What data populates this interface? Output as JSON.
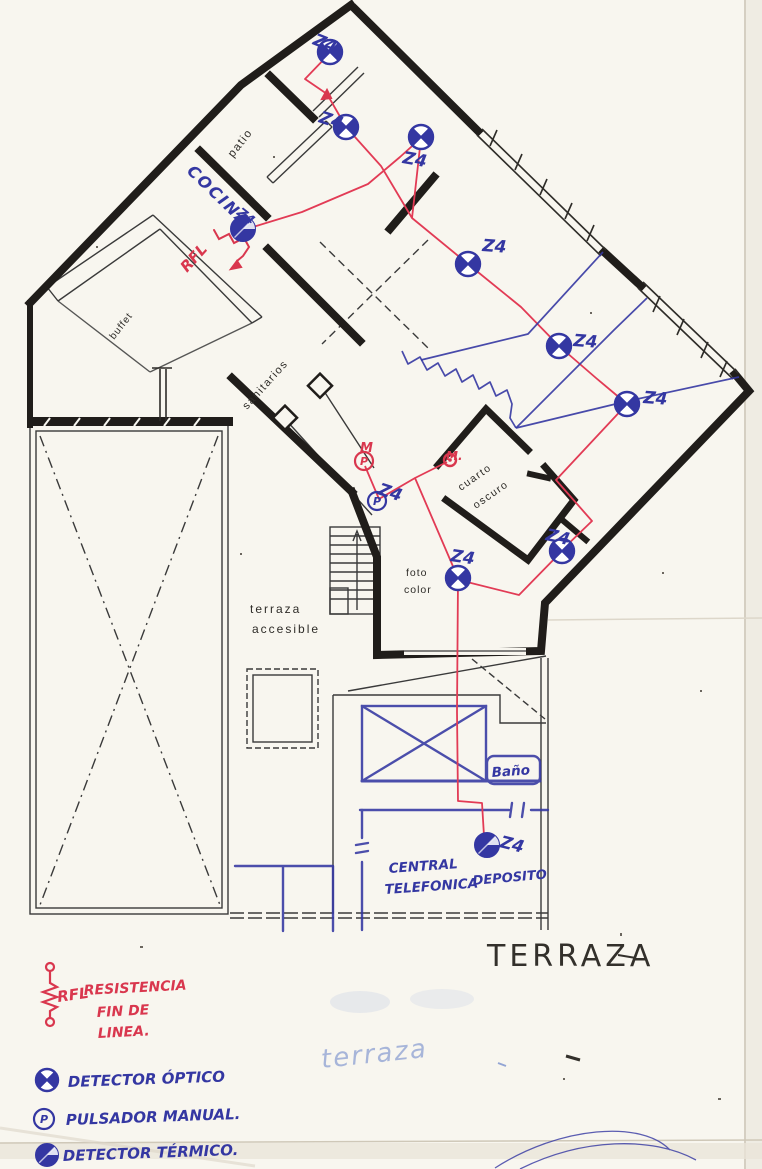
{
  "palette": {
    "pen_red": "#d9374e",
    "wire_red": "#e23b55",
    "pen_blue": "#3437a2",
    "faint_blue": "#93a5d4",
    "wall_black": "#201d1a",
    "print_gray": "#3a3a3a",
    "paper": "#f8f6ef"
  },
  "rooms": {
    "patio": "patio",
    "buffet": "buffet",
    "sanitarios": "sanitarios",
    "cuarto_line1": "cuarto",
    "cuarto_line2": "oscuro",
    "foto_line1": "foto",
    "foto_line2": "color",
    "terraza_line1": "terraza",
    "terraza_line2": "accesible",
    "cocina": "COCINA",
    "cocina_zone": "Z4",
    "bano": "Baño",
    "central_line1": "CENTRAL",
    "central_line2": "TELEFONICA",
    "deposito": "DEPOSITO"
  },
  "annotations": {
    "terraza_title": "TERRAZA",
    "terraza_faint": "terraza",
    "rfl": "RFL",
    "m1": "M",
    "m2": "M."
  },
  "zones": {
    "label": "Z4",
    "positions": [
      {
        "x": 312,
        "y": 44,
        "rot": 22
      },
      {
        "x": 318,
        "y": 122,
        "rot": 18
      },
      {
        "x": 402,
        "y": 163,
        "rot": 10
      },
      {
        "x": 482,
        "y": 251,
        "rot": 4
      },
      {
        "x": 573,
        "y": 346,
        "rot": 4
      },
      {
        "x": 643,
        "y": 403,
        "rot": 4
      },
      {
        "x": 545,
        "y": 540,
        "rot": 12
      },
      {
        "x": 377,
        "y": 494,
        "rot": 18
      },
      {
        "x": 450,
        "y": 561,
        "rot": 8
      },
      {
        "x": 499,
        "y": 847,
        "rot": 14
      }
    ]
  },
  "devices": [
    {
      "type": "optico",
      "x": 330,
      "y": 52
    },
    {
      "type": "optico",
      "x": 346,
      "y": 127
    },
    {
      "type": "optico",
      "x": 421,
      "y": 137
    },
    {
      "type": "optico",
      "x": 468,
      "y": 264
    },
    {
      "type": "optico",
      "x": 559,
      "y": 346
    },
    {
      "type": "optico",
      "x": 627,
      "y": 404
    },
    {
      "type": "optico",
      "x": 562,
      "y": 551
    },
    {
      "type": "optico",
      "x": 458,
      "y": 578
    },
    {
      "type": "termico",
      "x": 487,
      "y": 845
    },
    {
      "type": "termico",
      "x": 243,
      "y": 229
    },
    {
      "type": "pulsador",
      "x": 377,
      "y": 501
    },
    {
      "type": "pulsador-red",
      "x": 364,
      "y": 461
    },
    {
      "type": "punto-red",
      "x": 450,
      "y": 460
    }
  ],
  "wires": {
    "red": [
      [
        [
          330,
          53
        ],
        [
          305,
          79
        ],
        [
          327,
          94
        ],
        [
          346,
          127
        ],
        [
          381,
          166
        ],
        [
          412,
          218
        ],
        [
          468,
          264
        ]
      ],
      [
        [
          240,
          231
        ],
        [
          302,
          212
        ],
        [
          368,
          184
        ],
        [
          400,
          157
        ],
        [
          421,
          138
        ]
      ],
      [
        [
          421,
          138
        ],
        [
          415,
          192
        ],
        [
          412,
          218
        ]
      ],
      [
        [
          468,
          264
        ],
        [
          521,
          307
        ],
        [
          559,
          346
        ],
        [
          596,
          378
        ],
        [
          627,
          404
        ]
      ],
      [
        [
          627,
          404
        ],
        [
          556,
          480
        ],
        [
          592,
          521
        ],
        [
          563,
          549
        ]
      ],
      [
        [
          562,
          551
        ],
        [
          519,
          595
        ],
        [
          459,
          580
        ]
      ],
      [
        [
          458,
          578
        ],
        [
          415,
          478
        ],
        [
          447,
          462
        ]
      ],
      [
        [
          415,
          478
        ],
        [
          379,
          499
        ],
        [
          365,
          466
        ]
      ],
      [
        [
          458,
          580
        ],
        [
          457,
          712
        ],
        [
          458,
          801
        ],
        [
          482,
          803
        ],
        [
          484,
          836
        ]
      ]
    ],
    "blue": [
      [
        [
          421,
          360
        ],
        [
          528,
          334
        ],
        [
          603,
          252
        ]
      ],
      [
        [
          516,
          428
        ],
        [
          614,
          330
        ],
        [
          647,
          298
        ]
      ],
      [
        [
          516,
          428
        ],
        [
          628,
          401
        ],
        [
          739,
          377
        ]
      ],
      [
        [
          402,
          351
        ],
        [
          408,
          364
        ],
        [
          420,
          357
        ],
        [
          427,
          370
        ],
        [
          438,
          363
        ],
        [
          445,
          376
        ],
        [
          456,
          369
        ],
        [
          462,
          382
        ],
        [
          473,
          375
        ],
        [
          479,
          389
        ],
        [
          490,
          382
        ],
        [
          496,
          396
        ],
        [
          507,
          390
        ],
        [
          512,
          404
        ],
        [
          510,
          418
        ],
        [
          516,
          428
        ]
      ]
    ]
  },
  "legend": {
    "rfl_abbr": "RFL",
    "rfl_line1": "RESISTENCIA",
    "rfl_line2": "FIN DE",
    "rfl_line3": "LINEA.",
    "optico": "DETECTOR ÓPTICO",
    "pulsador": "PULSADOR MANUAL.",
    "termico": "DETECTOR TÉRMICO."
  }
}
